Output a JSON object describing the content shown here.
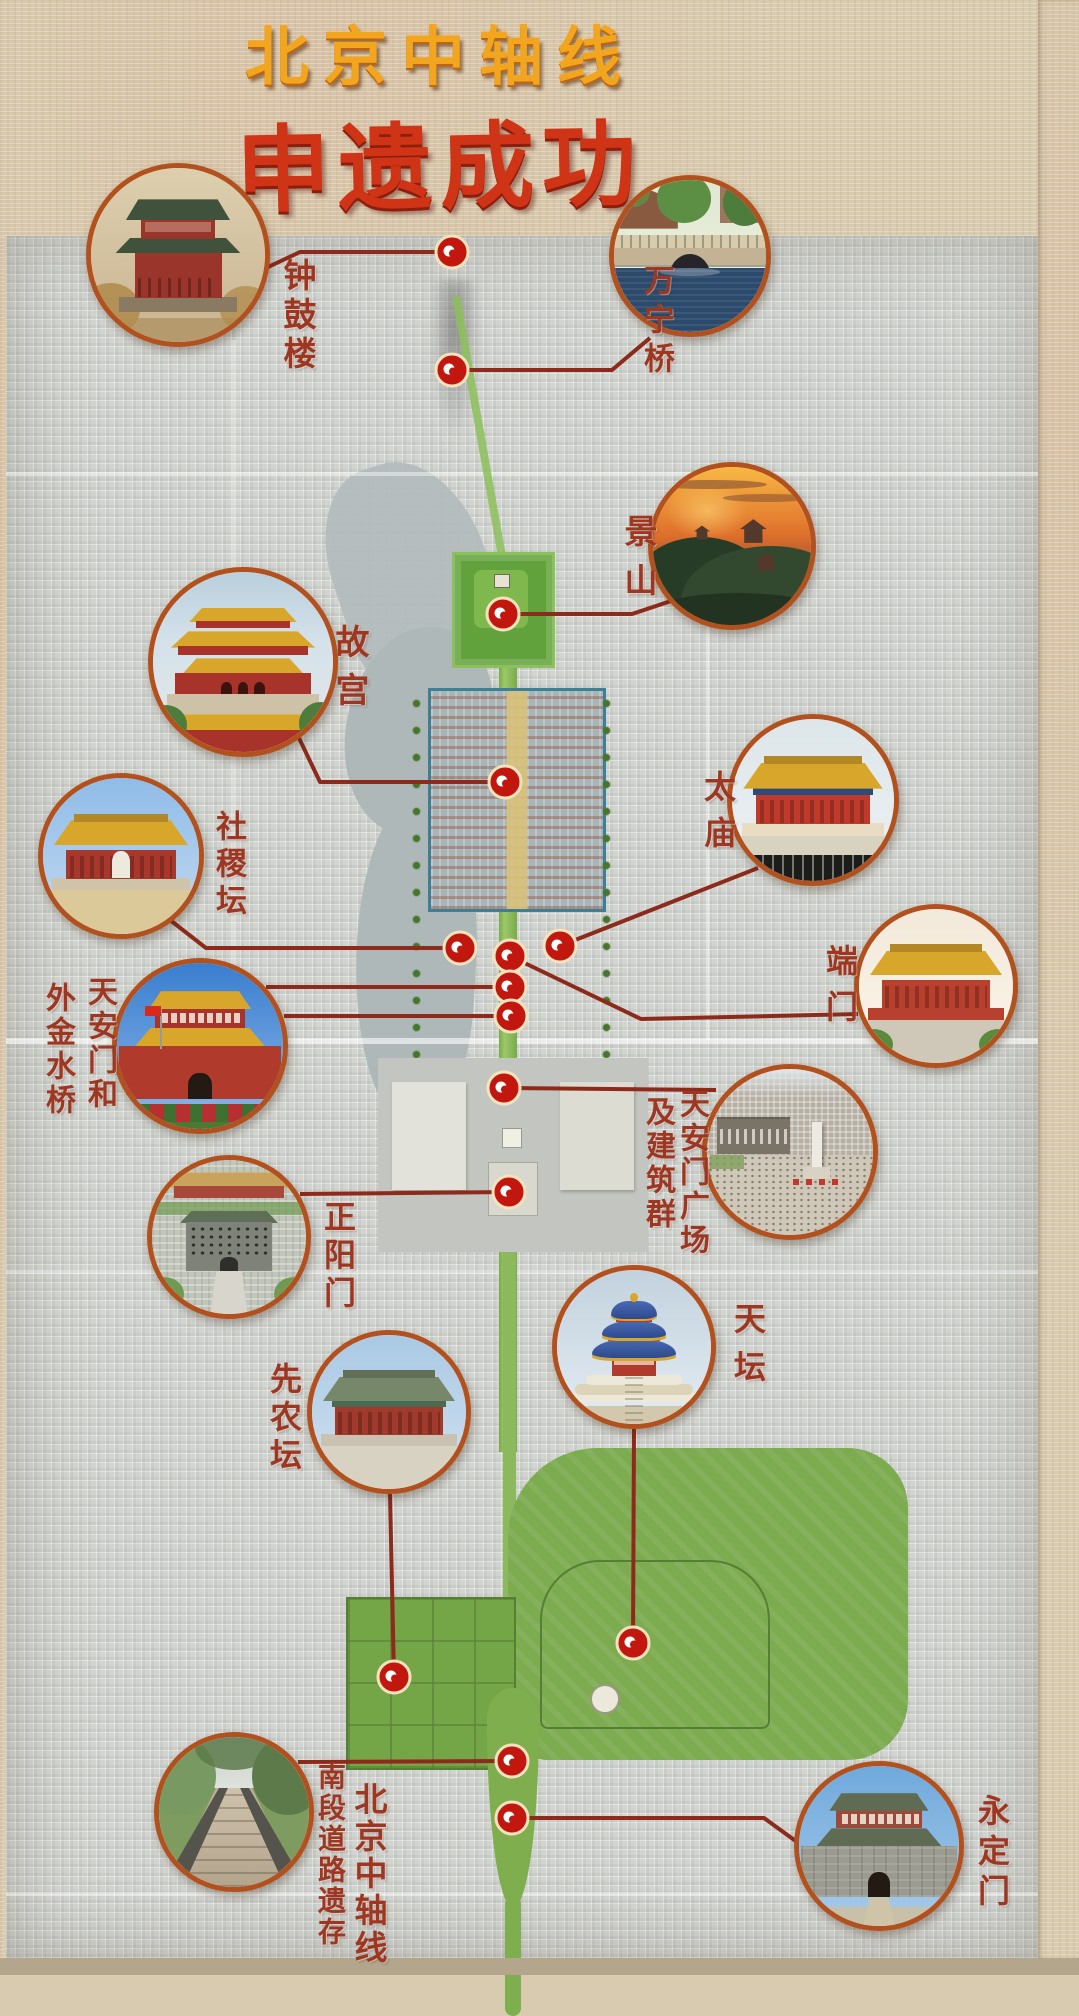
{
  "header": {
    "title": "北京中轴线",
    "subtitle": "申遗成功"
  },
  "colors": {
    "title_gold": "#f2a51f",
    "title_red": "#cf3416",
    "label_red": "#9e3722",
    "line_red": "#8c2a1b",
    "marker_red": "#c2170f",
    "marker_ring": "#f6e3be",
    "circle_ring": "#b2511d",
    "axis_green": "#8cc05a",
    "map_gray": "#d2d4d0",
    "paper": "#d8cbb0"
  },
  "sites": [
    {
      "id": "zhonggulou",
      "name": "钟鼓楼",
      "label_columns": [
        {
          "text": "钟鼓楼",
          "x": 281,
          "y": 258,
          "size": 33,
          "gap": 6
        }
      ],
      "circle": {
        "x": 178,
        "y": 255,
        "r": 92
      },
      "markers": [
        [
          452,
          252
        ]
      ],
      "lines": [
        [
          [
            266,
            268
          ],
          [
            300,
            252
          ],
          [
            452,
            252
          ]
        ]
      ],
      "photo": {
        "kind": "tower",
        "c": {
          "sky1": "#ddcfae",
          "sky2": "#c9b492",
          "roof": "#41523c",
          "body": "#99352a",
          "trees": "#b08d4f",
          "base": "#8a7a62",
          "ground": "#b59a6e"
        }
      }
    },
    {
      "id": "wanningqiao",
      "name": "万宁桥",
      "label_columns": [
        {
          "text": "万宁桥",
          "x": 640,
          "y": 264,
          "size": 31,
          "gap": 8
        }
      ],
      "circle": {
        "x": 690,
        "y": 256,
        "r": 81
      },
      "markers": [
        [
          452,
          370
        ]
      ],
      "lines": [
        [
          [
            452,
            370
          ],
          [
            612,
            370
          ],
          [
            650,
            338
          ]
        ]
      ],
      "photo": {
        "kind": "bridge",
        "c": {
          "bldg": "#8a5a40",
          "treeL": "#5c8f43",
          "stone": "#c3b394",
          "arch": "#26262a",
          "water": "#2c4a6b"
        }
      }
    },
    {
      "id": "jingshan",
      "name": "景山",
      "label_columns": [
        {
          "text": "景山",
          "x": 622,
          "y": 514,
          "size": 33,
          "gap": 16
        }
      ],
      "circle": {
        "x": 732,
        "y": 546,
        "r": 84
      },
      "markers": [
        [
          503,
          614
        ]
      ],
      "lines": [
        [
          [
            503,
            614
          ],
          [
            632,
            614
          ],
          [
            674,
            600
          ]
        ]
      ],
      "photo": {
        "kind": "hill",
        "c": {
          "sky1": "#f7b844",
          "sky2": "#e0712c",
          "sky3": "#8e4a33",
          "hill": "#32492f",
          "hill2": "#273c27",
          "sil": "#53392c"
        }
      }
    },
    {
      "id": "gugong",
      "name": "故宫",
      "label_columns": [
        {
          "text": "故宫",
          "x": 332,
          "y": 624,
          "size": 34,
          "gap": 14
        }
      ],
      "circle": {
        "x": 243,
        "y": 662,
        "r": 95
      },
      "markers": [
        [
          505,
          782
        ]
      ],
      "lines": [
        [
          [
            298,
            736
          ],
          [
            320,
            782
          ],
          [
            505,
            782
          ]
        ]
      ],
      "photo": {
        "kind": "palace",
        "c": {
          "roof": "#d9a62c",
          "body": "#a8332a",
          "ground": "#cdc2a8"
        }
      }
    },
    {
      "id": "shejitan",
      "name": "社稷坛",
      "label_columns": [
        {
          "text": "社稷坛",
          "x": 212,
          "y": 810,
          "size": 31,
          "gap": 6
        }
      ],
      "circle": {
        "x": 121,
        "y": 856,
        "r": 83
      },
      "markers": [
        [
          460,
          948
        ]
      ],
      "lines": [
        [
          [
            170,
            920
          ],
          [
            206,
            948
          ],
          [
            460,
            948
          ]
        ]
      ],
      "photo": {
        "kind": "hall",
        "c": {
          "sky1": "#8fbce8",
          "sky2": "#c5daf0",
          "roof": "#d9a62c",
          "body": "#a8382c",
          "arch": "white",
          "ground": "#dcc99a",
          "base": "#cfc4aa"
        }
      }
    },
    {
      "id": "taimiao",
      "name": "太庙",
      "label_columns": [
        {
          "text": "太庙",
          "x": 702,
          "y": 770,
          "size": 32,
          "gap": 14
        }
      ],
      "circle": {
        "x": 813,
        "y": 800,
        "r": 86
      },
      "markers": [
        [
          560,
          946
        ]
      ],
      "lines": [
        [
          [
            560,
            946
          ],
          [
            758,
            868
          ]
        ]
      ],
      "photo": {
        "kind": "hall",
        "c": {
          "sky1": "#dde6ea",
          "sky2": "#eef2f4",
          "roof": "#d9a62c",
          "band": "#2e4a78",
          "body": "#c03a2c",
          "fence": "#1c1c1a",
          "ground": "#d8d2c0",
          "base": "#e8ddc2"
        }
      }
    },
    {
      "id": "duanmen",
      "name": "端门",
      "label_columns": [
        {
          "text": "端门",
          "x": 824,
          "y": 944,
          "size": 32,
          "gap": 14
        }
      ],
      "circle": {
        "x": 936,
        "y": 986,
        "r": 82
      },
      "markers": [
        [
          510,
          956
        ]
      ],
      "lines": [
        [
          [
            510,
            956
          ],
          [
            641,
            1019
          ],
          [
            858,
            1014
          ]
        ]
      ],
      "photo": {
        "kind": "hall",
        "c": {
          "sky1": "#f2e9da",
          "sky2": "#fbf5ea",
          "roof": "#d9a62c",
          "body": "#b8402e",
          "green": "#5a8a3c",
          "ground": "#cfc8b8",
          "base": "#b8402e"
        }
      }
    },
    {
      "id": "tiananmen-jinshuiqiao",
      "name": "天安门和外金水桥",
      "label_columns": [
        {
          "text": "天安门和",
          "x": 84,
          "y": 976,
          "size": 30,
          "gap": 4
        },
        {
          "text": "外金水桥",
          "x": 42,
          "y": 982,
          "size": 30,
          "gap": 4
        }
      ],
      "circle": {
        "x": 200,
        "y": 1046,
        "r": 88
      },
      "markers": [
        [
          510,
          987
        ],
        [
          511,
          1016
        ]
      ],
      "lines": [
        [
          [
            510,
            987
          ],
          [
            266,
            987
          ]
        ],
        [
          [
            511,
            1016
          ],
          [
            284,
            1016
          ]
        ]
      ],
      "photo": {
        "kind": "gate",
        "c": {
          "sky1": "#3a7ecf",
          "sky2": "#8fb8e8",
          "roof": "#d9a62c",
          "body": "#a8332a",
          "wall": "#b03a2c",
          "shrub": "#b53030",
          "ground": "#4a7a34",
          "flag": true
        }
      }
    },
    {
      "id": "guangchang",
      "name": "天安门广场及建筑群",
      "label_columns": [
        {
          "text": "天安门广场",
          "x": 676,
          "y": 1088,
          "size": 30,
          "gap": 4
        },
        {
          "text": "及建筑群",
          "x": 642,
          "y": 1096,
          "size": 30,
          "gap": 4
        }
      ],
      "circle": {
        "x": 790,
        "y": 1152,
        "r": 88
      },
      "markers": [
        [
          504,
          1088
        ]
      ],
      "lines": [
        [
          [
            504,
            1088
          ],
          [
            716,
            1090
          ]
        ]
      ],
      "photo": {
        "kind": "aerial",
        "c": {
          "city": "#b6b0a4",
          "sky": "#dfe5ea",
          "building": "#7a7468",
          "square": "#cfc8b8",
          "monument": "#eceae2"
        }
      }
    },
    {
      "id": "zhengyangmen",
      "name": "正阳门",
      "label_columns": [
        {
          "text": "正阳门",
          "x": 322,
          "y": 1200,
          "size": 32,
          "gap": 6
        }
      ],
      "circle": {
        "x": 229,
        "y": 1237,
        "r": 82
      },
      "markers": [
        [
          509,
          1192
        ]
      ],
      "lines": [
        [
          [
            509,
            1192
          ],
          [
            300,
            1194
          ]
        ]
      ],
      "photo": {
        "kind": "aerialgate",
        "c": {
          "bg2": "#c2c6ba",
          "gate": "#7e8278",
          "roofg": "#5f6f57",
          "arch": "#2e2e2a",
          "road": "#d8d5cc"
        }
      }
    },
    {
      "id": "tiantan",
      "name": "天坛",
      "label_columns": [
        {
          "text": "天坛",
          "x": 732,
          "y": 1302,
          "size": 32,
          "gap": 16
        }
      ],
      "circle": {
        "x": 634,
        "y": 1347,
        "r": 82
      },
      "markers": [
        [
          633,
          1643
        ]
      ],
      "lines": [
        [
          [
            634,
            1429
          ],
          [
            633,
            1643
          ]
        ]
      ],
      "photo": {
        "kind": "round",
        "c": {
          "sky1": "#c2d2de",
          "sky2": "#e4ecf2",
          "roof": "#2e4a8e",
          "roofhi": "#4a6ab2",
          "gold": "#d9a62c",
          "body": "#b03a2c",
          "white": "#ece8da",
          "ground": "#d2c8ae"
        }
      }
    },
    {
      "id": "xiannongtan",
      "name": "先农坛",
      "label_columns": [
        {
          "text": "先农坛",
          "x": 268,
          "y": 1362,
          "size": 32,
          "gap": 6
        }
      ],
      "circle": {
        "x": 389,
        "y": 1412,
        "r": 82
      },
      "markers": [
        [
          394,
          1677
        ]
      ],
      "lines": [
        [
          [
            390,
            1494
          ],
          [
            394,
            1677
          ]
        ]
      ],
      "photo": {
        "kind": "hall",
        "c": {
          "sky1": "#a9c9e4",
          "sky2": "#d2e2f0",
          "roof": "#77876a",
          "body": "#a03a2c",
          "band": "#4a6a52",
          "ground": "#d8d2c2",
          "base": "#c9c2b2"
        }
      }
    },
    {
      "id": "nanduan-daolu",
      "name": "北京中轴线南段道路遗存",
      "label_columns": [
        {
          "text": "北京中轴线",
          "x": 352,
          "y": 1782,
          "size": 33,
          "gap": 4
        },
        {
          "text": "南段道路遗存",
          "x": 316,
          "y": 1762,
          "size": 28,
          "gap": 3
        }
      ],
      "circle": {
        "x": 234,
        "y": 1812,
        "r": 80
      },
      "markers": [
        [
          512,
          1761
        ]
      ],
      "lines": [
        [
          [
            512,
            1761
          ],
          [
            298,
            1762
          ]
        ]
      ],
      "photo": {
        "kind": "path",
        "c": {
          "sky": "#c9cfc9",
          "tree": "#789a62",
          "tree2": "#5c7a4a",
          "path": "#bcae98",
          "gravel": "#55544c"
        }
      }
    },
    {
      "id": "yongdingmen",
      "name": "永定门",
      "label_columns": [
        {
          "text": "永定门",
          "x": 976,
          "y": 1794,
          "size": 32,
          "gap": 8
        }
      ],
      "circle": {
        "x": 879,
        "y": 1846,
        "r": 85
      },
      "markers": [
        [
          512,
          1818
        ]
      ],
      "lines": [
        [
          [
            512,
            1818
          ],
          [
            764,
            1818
          ],
          [
            797,
            1842
          ]
        ]
      ],
      "photo": {
        "kind": "gate",
        "c": {
          "sky1": "#6fa9dc",
          "sky2": "#a9cbe8",
          "roof": "#5f6b52",
          "body": "#9a4a3a",
          "wall": "#9a9a90",
          "ground": "#c9c0aa",
          "stone": true
        }
      }
    }
  ]
}
